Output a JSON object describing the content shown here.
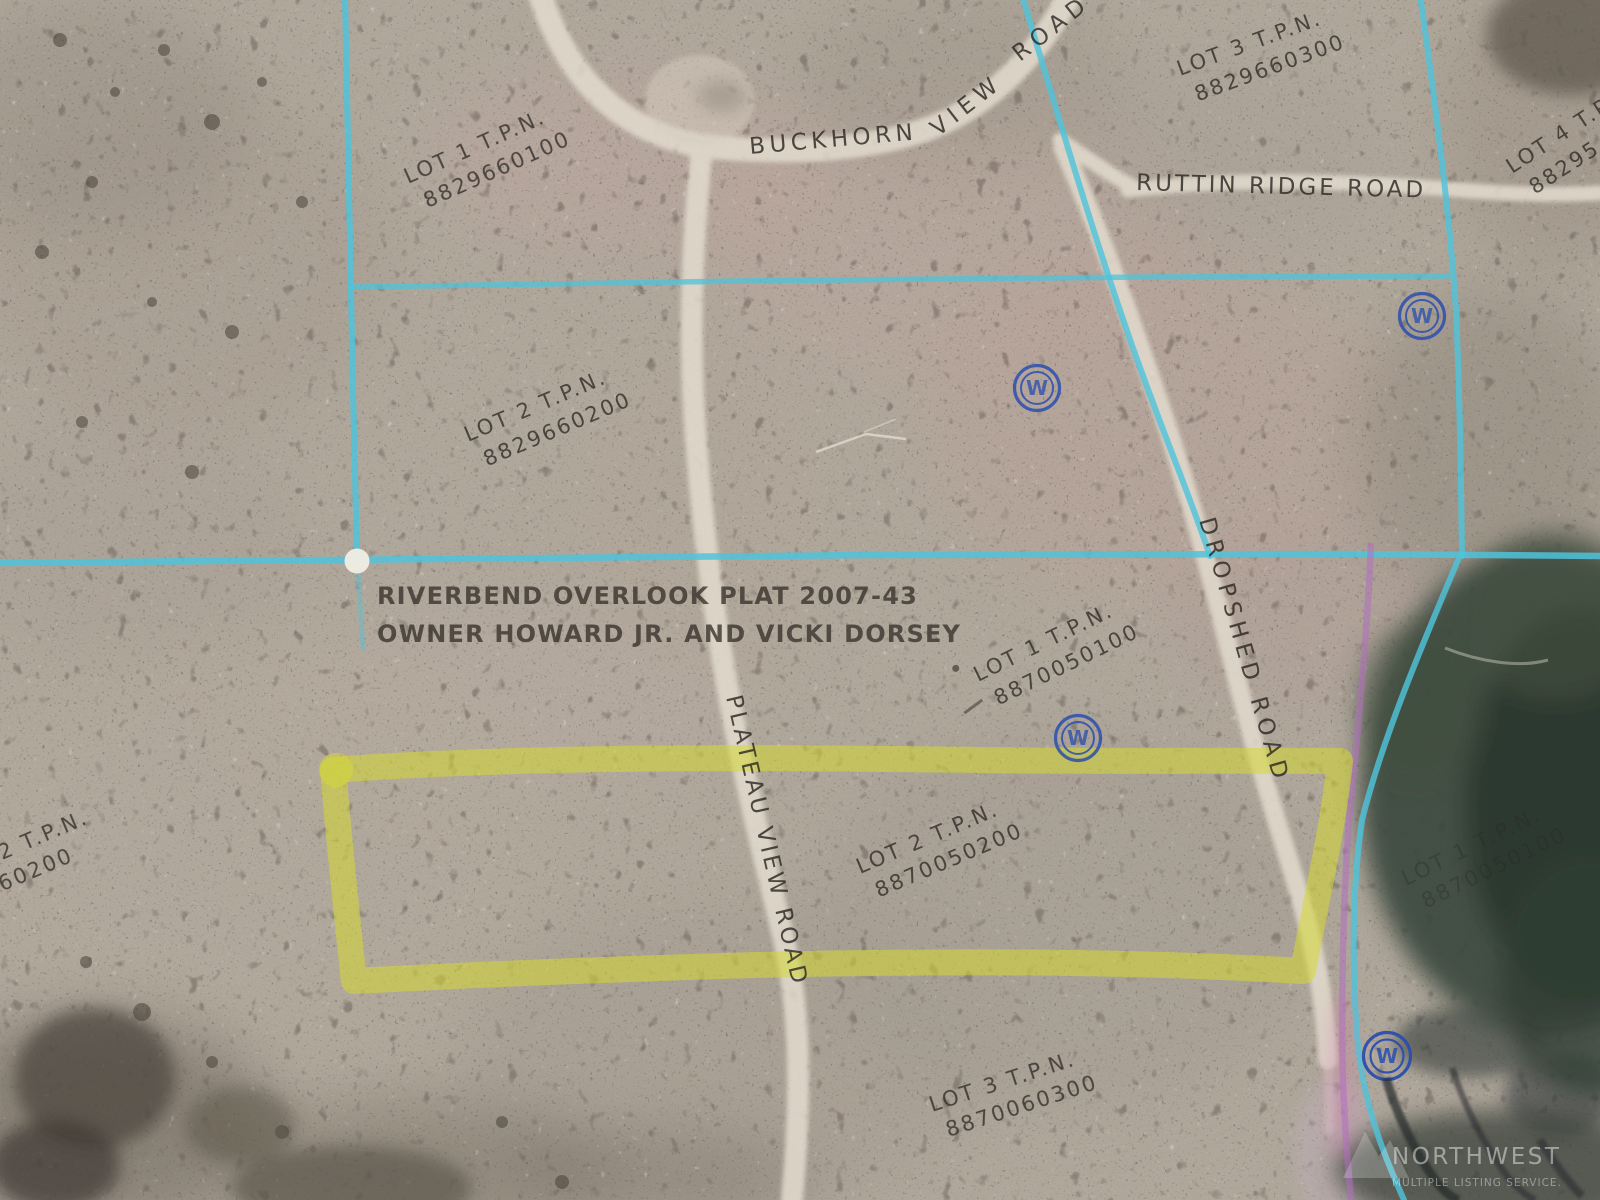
{
  "colors": {
    "boundary_cyan": "#4fc3da",
    "highlight_yellow": "#d6d931",
    "plat_purple": "#b070c0",
    "well_blue": "#2b4fae"
  },
  "map": {
    "plat_title": {
      "line1": "RIVERBEND OVERLOOK PLAT 2007-43",
      "line2": "OWNER HOWARD JR. AND VICKI DORSEY"
    },
    "roads": {
      "buckhorn": "BUCKHORN",
      "view": "VIEW",
      "road": "ROAD",
      "ruttin_ridge": "RUTTIN RIDGE ROAD",
      "dropshed": "DROPSHED ROAD",
      "plateau_view": "PLATEAU VIEW ROAD"
    },
    "parcels": [
      {
        "lot": "LOT 1 T.P.N.",
        "tpn": "8829660100"
      },
      {
        "lot": "LOT 2 T.P.N.",
        "tpn": "8829660200"
      },
      {
        "lot": "LOT 3 T.P.N.",
        "tpn": "8829660300"
      },
      {
        "lot": "LOT 4 T.P.N.",
        "tpn": "88295"
      },
      {
        "lot": "LOT 1 T.P.N.",
        "tpn": "8870050100"
      },
      {
        "lot": "LOT 2 T.P.N.",
        "tpn": "8870050200"
      },
      {
        "lot": "LOT 3 T.P.N.",
        "tpn": "8870060300"
      },
      {
        "lot": "2 T.P.N.",
        "tpn": "960200"
      },
      {
        "lot": "LOT 1 T.P.N.",
        "tpn": "8870050100"
      }
    ],
    "well_symbol": "W",
    "watermark": {
      "line1": "NORTHWEST",
      "line2": "MULTIPLE LISTING SERVICE."
    }
  }
}
